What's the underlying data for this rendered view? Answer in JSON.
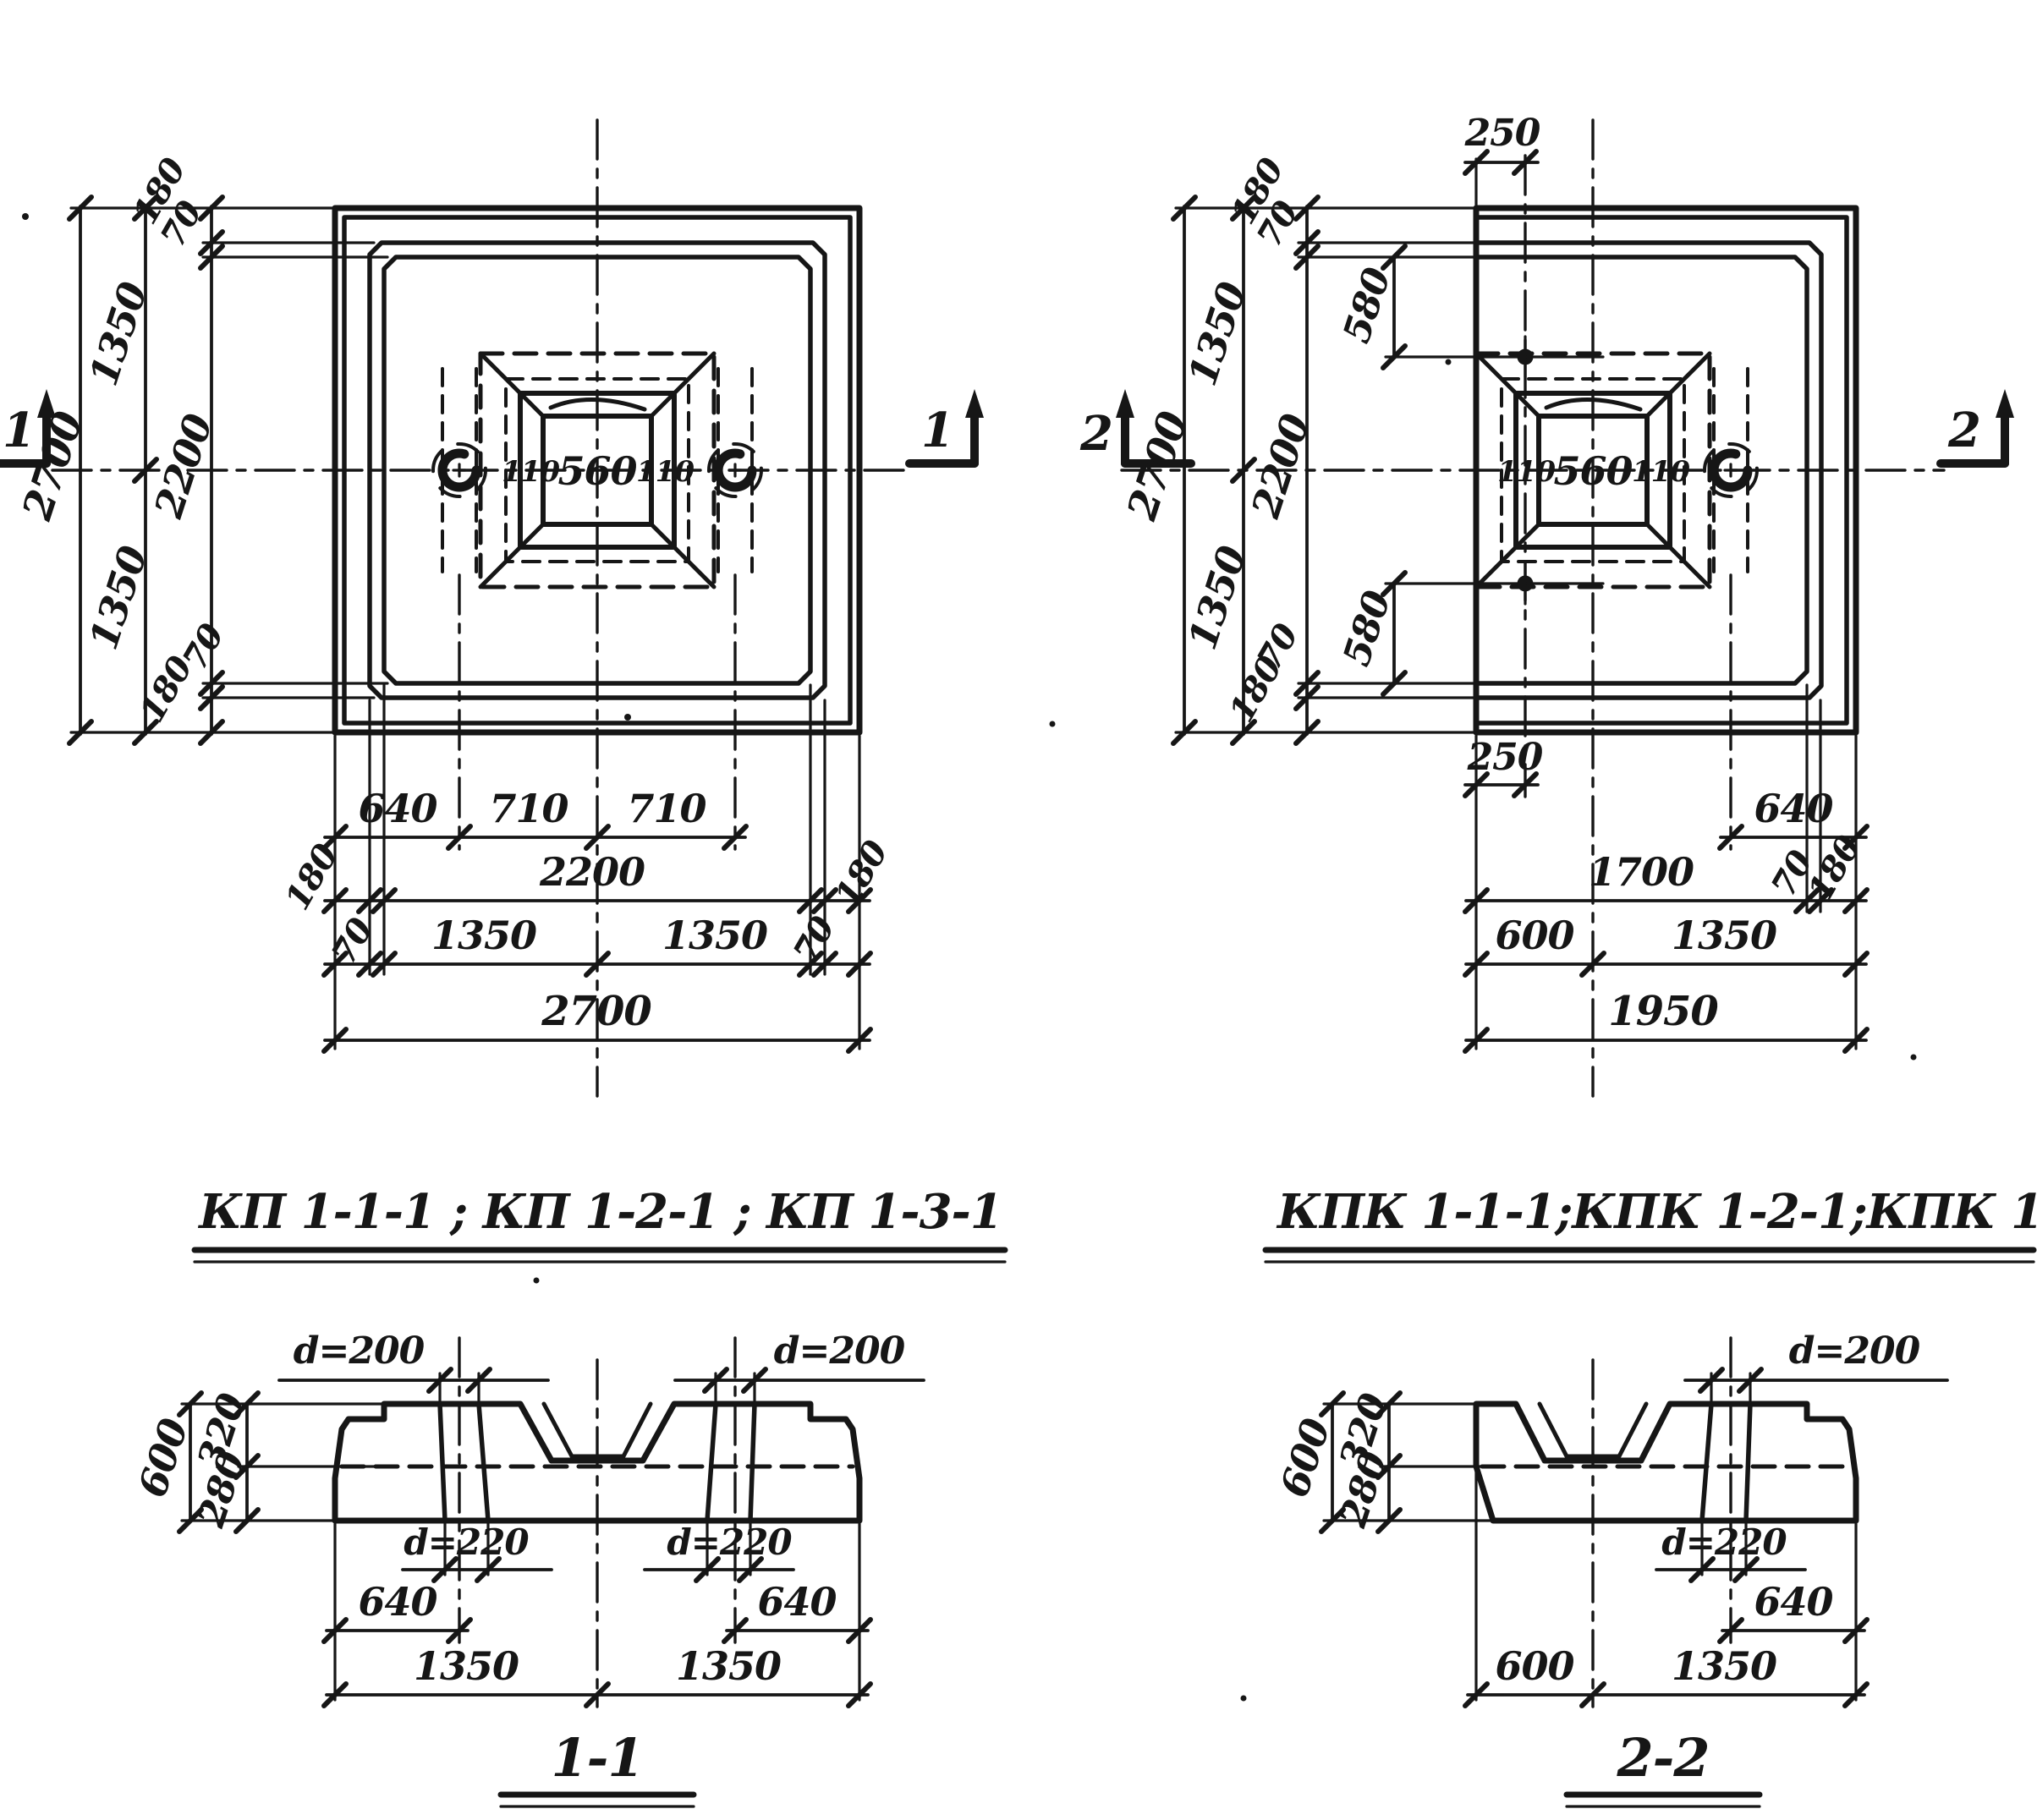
{
  "colors": {
    "ink": "#161616",
    "paper": "#ffffff"
  },
  "plan_kp": {
    "title": "КП 1-1-1 ; КП 1-2-1 ; КП 1-3-1",
    "section_marker": "1",
    "side_dims": {
      "edge_outer_top": "180",
      "edge_inner_top": "70",
      "half_top": "1350",
      "overall": "2700",
      "inner": "2200",
      "half_bottom": "1350",
      "edge_inner_bottom": "70",
      "edge_outer_bottom": "180"
    },
    "socket_dims": {
      "wall_left": "110",
      "width": "560",
      "wall_right": "110"
    },
    "bottom_rows": {
      "row1": [
        "640",
        "710",
        "710"
      ],
      "row2": [
        "180",
        "2200",
        "180"
      ],
      "row3": [
        "70",
        "1350",
        "1350",
        "70"
      ],
      "row4": "2700"
    }
  },
  "plan_kpk": {
    "title": "КПК 1-1-1;КПК 1-2-1;КПК 1-3-1",
    "section_marker": "2",
    "hole_offset_x": "250",
    "hole_offset_y": "580",
    "side_dims": {
      "edge_outer_top": "180",
      "edge_inner_top": "70",
      "half_top": "1350",
      "overall": "2700",
      "inner": "2200",
      "half_bottom": "1350",
      "edge_inner_bottom": "70",
      "edge_outer_bottom": "180"
    },
    "socket_dims": {
      "wall_left": "110",
      "width": "560",
      "wall_right": "110"
    },
    "bottom_rows": {
      "row_loop": "640",
      "row1": [
        "1700",
        "70",
        "180"
      ],
      "row2": [
        "600",
        "1350"
      ],
      "row3": "1950"
    }
  },
  "section_11": {
    "label": "1-1",
    "heights": {
      "overall": "600",
      "upper": "320",
      "lower": "280"
    },
    "pipe_top_dia": "d=200",
    "pipe_bottom_dia": "d=220",
    "pipe_edge_offset": "640",
    "halves": [
      "1350",
      "1350"
    ]
  },
  "section_22": {
    "label": "2-2",
    "heights": {
      "overall": "600",
      "upper": "320",
      "lower": "280"
    },
    "pipe_top_dia": "d=200",
    "pipe_bottom_dia": "d=220",
    "pipe_edge_offset": "640",
    "bottom": [
      "600",
      "1350"
    ]
  }
}
